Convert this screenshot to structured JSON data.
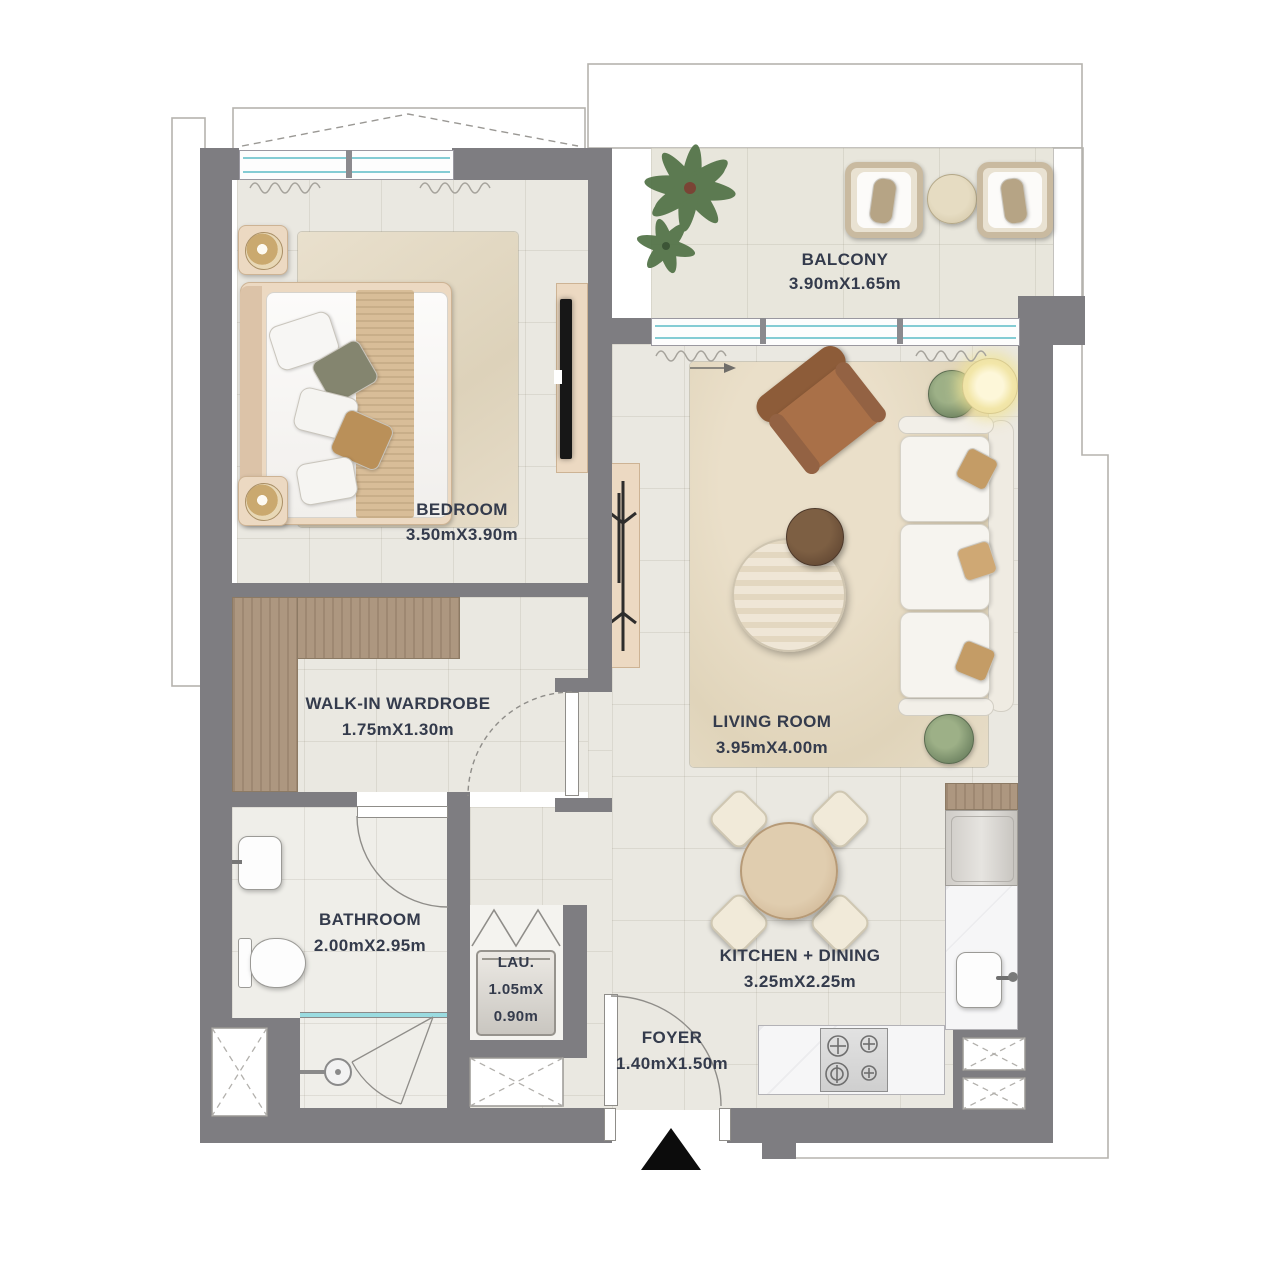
{
  "plan": {
    "title": "one-bedroom apartment floor plan",
    "rooms": [
      {
        "id": "balcony",
        "label": "BALCONY",
        "dims": "3.90mX1.65m"
      },
      {
        "id": "bedroom",
        "label": "BEDROOM",
        "dims": "3.50mX3.90m"
      },
      {
        "id": "walk_in_wardrobe",
        "label": "WALK-IN WARDROBE",
        "dims": "1.75mX1.30m"
      },
      {
        "id": "living_room",
        "label": "LIVING ROOM",
        "dims": "3.95mX4.00m"
      },
      {
        "id": "bathroom",
        "label": "BATHROOM",
        "dims": "2.00mX2.95m"
      },
      {
        "id": "laundry",
        "label": "LAU.",
        "dims_line1": "1.05mX",
        "dims_line2": "0.90m"
      },
      {
        "id": "kitchen_dining",
        "label": "KITCHEN + DINING",
        "dims": "3.25mX2.25m"
      },
      {
        "id": "foyer",
        "label": "FOYER",
        "dims": "1.40mX1.50m"
      }
    ],
    "colors": {
      "wall": "#7e7d81",
      "window_glass": "#84ccd4",
      "label_text": "#343b4c",
      "wood": "#ad9780",
      "floor_tile": "#eae8e1",
      "entrance_marker": "#0c0c0c"
    }
  }
}
